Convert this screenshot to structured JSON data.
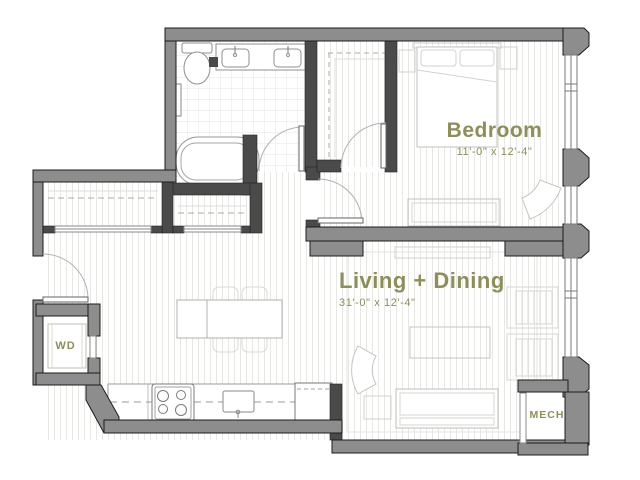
{
  "floorplan": {
    "rooms": {
      "bedroom": {
        "name": "Bedroom",
        "dims": "11'-0\" x 12'-4\""
      },
      "living": {
        "name": "Living + Dining",
        "dims": "31'-0\" x 12'-4\""
      },
      "washer_dryer": {
        "name": "WD"
      },
      "mechanical": {
        "name": "MECH"
      }
    },
    "colors": {
      "label": "#8E8E58",
      "exterior_wall": "#8D8D8D",
      "interior_wall": "#4A4A4A",
      "fixture_line": "#8F8F8F",
      "furniture_line": "#C4C4C0",
      "floor_line": "#E7E7E3"
    },
    "fixtures": [
      "toilet",
      "double-vanity-sinks",
      "bathtub",
      "closet-rods",
      "range-stove",
      "kitchen-sink",
      "refrigerator",
      "washer-dryer-unit",
      "dining-table-chairs",
      "bed",
      "nightstands",
      "dresser",
      "sofa",
      "coffee-table",
      "armchair",
      "accent-chairs",
      "media-console",
      "area-rug"
    ]
  }
}
